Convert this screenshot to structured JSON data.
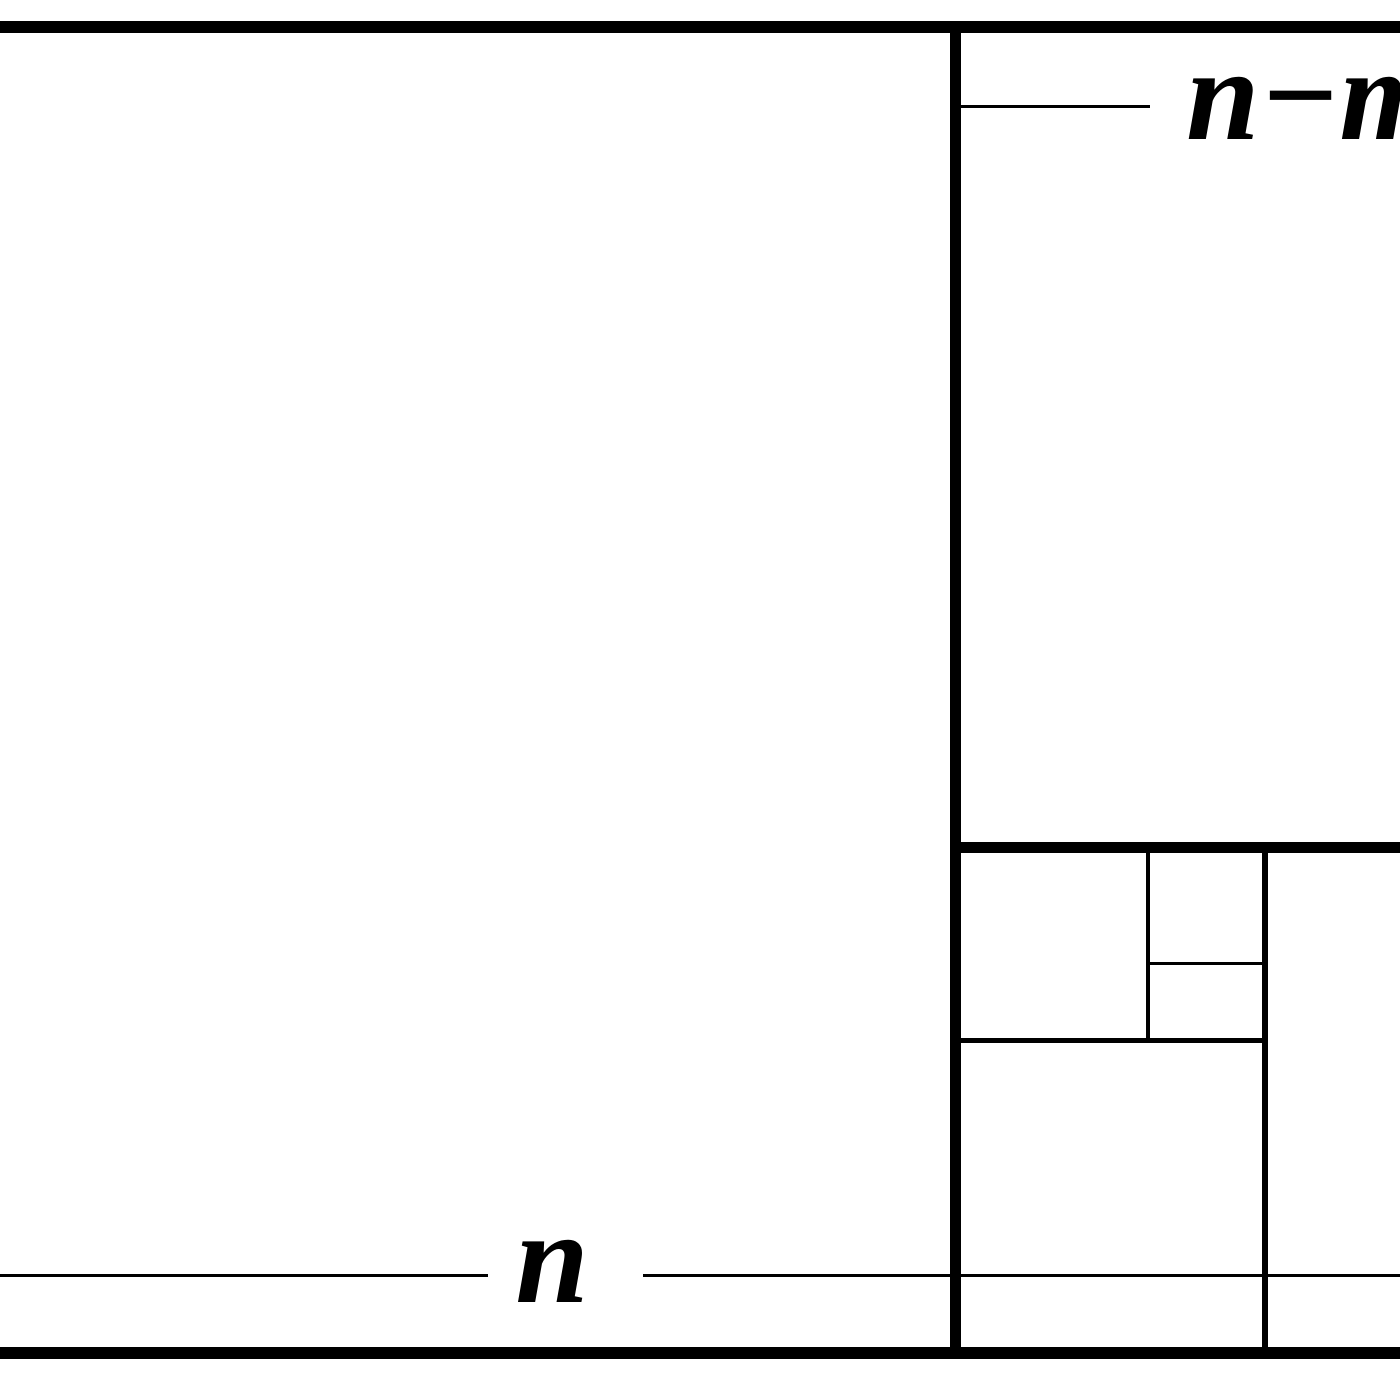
{
  "figure": {
    "description": "Rectangle subdivided into squares (Euclidean algorithm / golden ratio descent diagram), cropped at left and right image edges",
    "background_color": "#ffffff",
    "line_color": "#000000",
    "text_color": "#000000",
    "labels": {
      "left_square_width": "n",
      "right_column_width": "n−m"
    }
  }
}
